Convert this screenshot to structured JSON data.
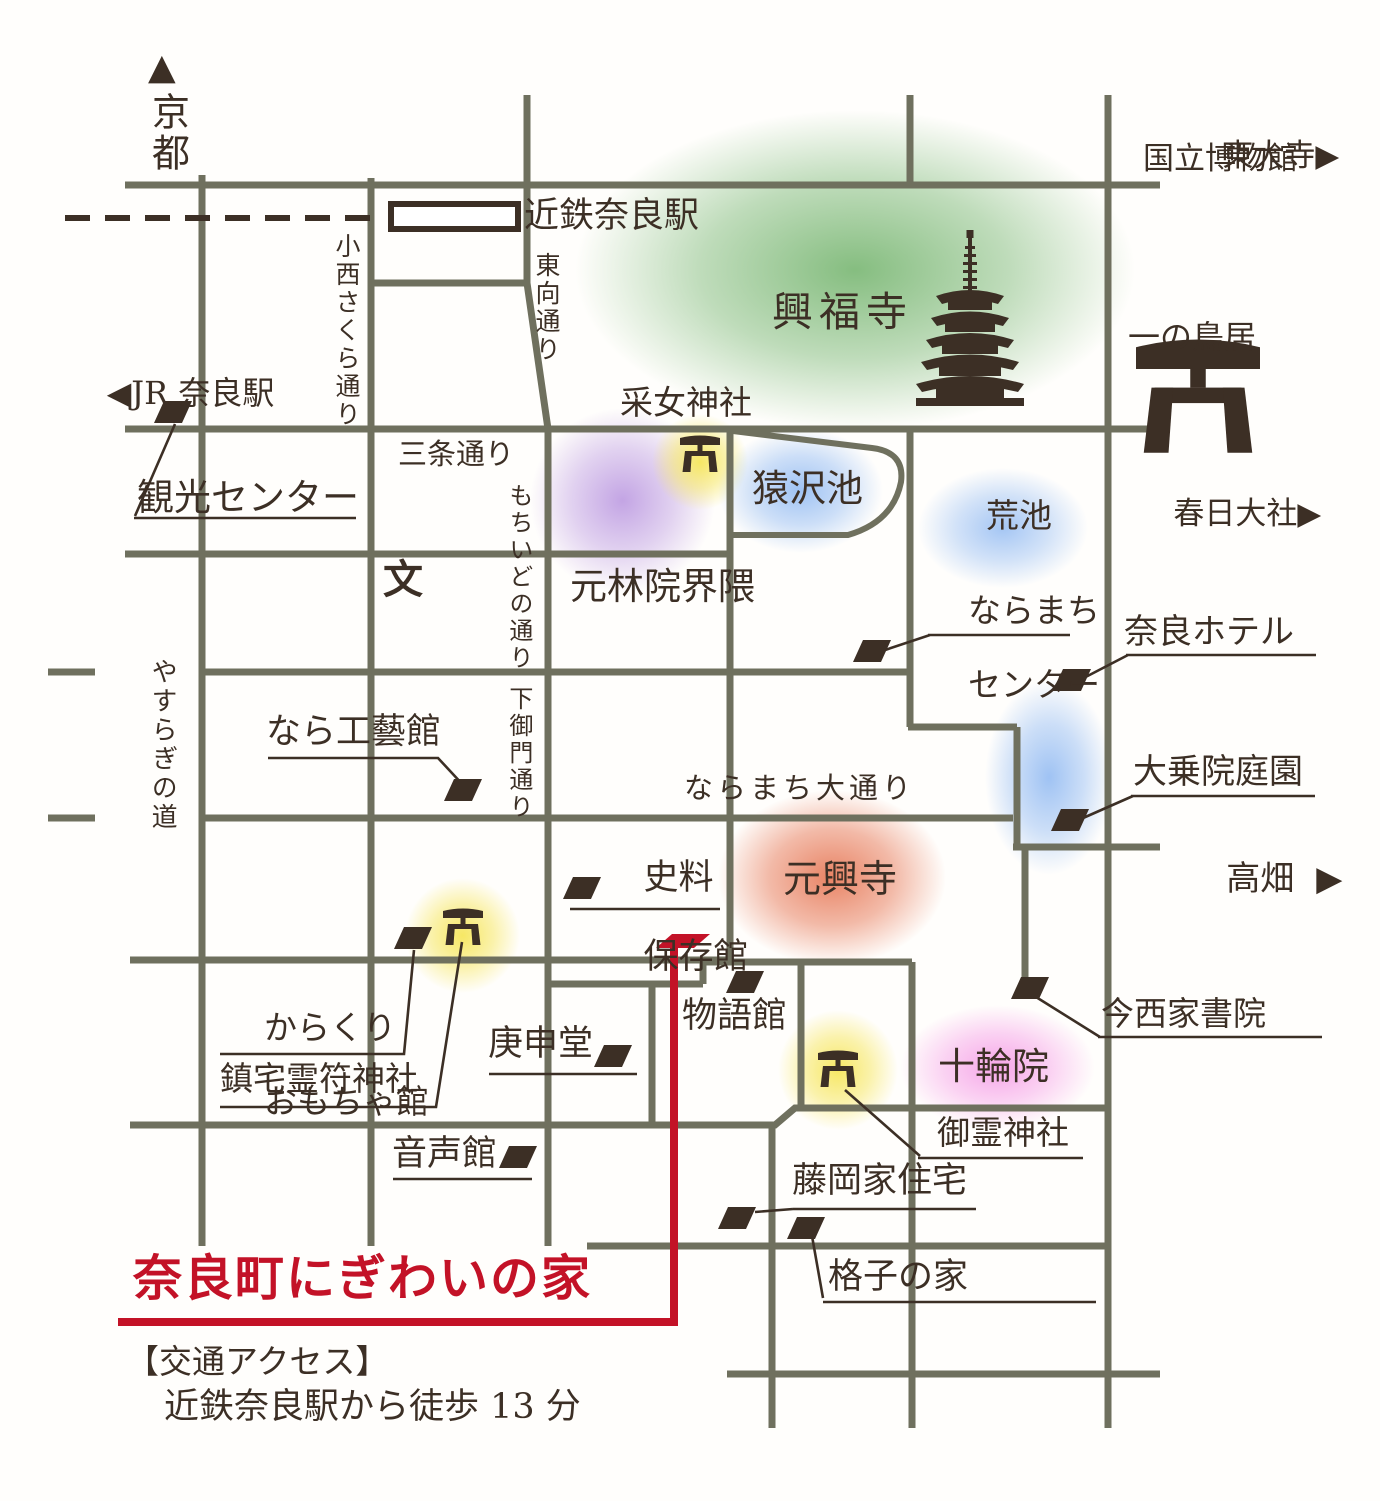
{
  "colors": {
    "bg": "#fffefc",
    "street": "#6f705e",
    "ink": "#3c2f25",
    "red": "#c31227",
    "green": "112,178,106",
    "purple": "180,142,222",
    "blue": "142,184,242",
    "yellow": "246,230,92",
    "orange": "230,118,84",
    "pink": "242,128,224"
  },
  "icons": {
    "up_arrow": "▲",
    "right_arrow": "▶",
    "left_arrow": "◀"
  },
  "labels": {
    "kyoto": "京都",
    "kintetsu_station": "近鉄奈良駅",
    "todaiji": "東大寺",
    "national_museum": "国立博物館",
    "jr_station": "JR 奈良駅",
    "konishi_sakura_st": "小西さくら通り",
    "higashimuki_st": "東向通り",
    "kofukuji": "興福寺",
    "ichino_torii": "一の鳥居",
    "kasuga_taisha": "春日大社",
    "uneme_shrine": "采女神社",
    "sanjo_st": "三条通り",
    "kanko_center": "観光センター",
    "mochiidono_st": "もちいどの通り",
    "sarusawa_pond": "猿沢池",
    "ara_pond": "荒池",
    "ganrinin": "元林院界隈",
    "school_symbol": "文",
    "naramachi_center_1": "ならまち",
    "naramachi_center_2": "センター",
    "nara_hotel": "奈良ホテル",
    "yasuragi_st": "やすらぎの道",
    "nara_kogeikan": "なら工藝館",
    "shimomikado_st": "下御門通り",
    "naramachi_odori": "ならまち大通り",
    "daijoin_garden": "大乗院庭園",
    "takabatake": "高畑",
    "shiryo_1": "史料",
    "shiryo_2": "保存館",
    "gangoji": "元興寺",
    "karakuri_1": "からくり",
    "karakuri_2": "おもちゃ館",
    "chintaku_shrine": "鎮宅霊符神社",
    "koshindo": "庚申堂",
    "monogatarikan": "物語館",
    "imanishi_shoin": "今西家書院",
    "jurinin": "十輪院",
    "goryo_shrine": "御霊神社",
    "onjokan": "音声館",
    "fujioka_house": "藤岡家住宅",
    "koshi_house": "格子の家",
    "title": "奈良町にぎわいの家",
    "access_heading": "【交通アクセス】",
    "access_detail": "近鉄奈良駅から徒歩 13 分"
  }
}
